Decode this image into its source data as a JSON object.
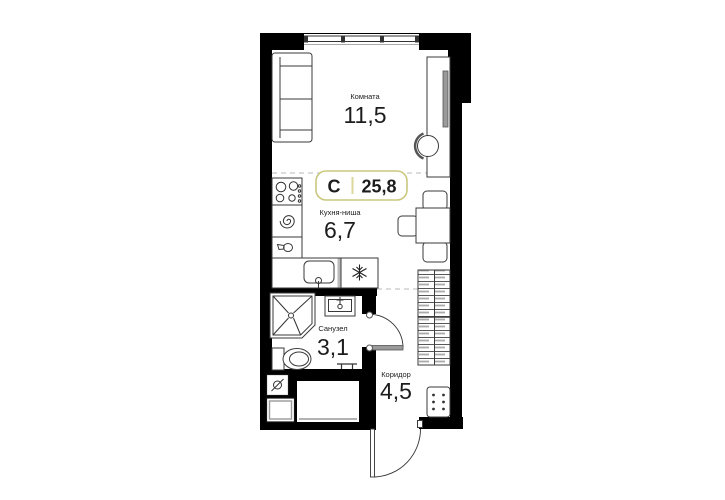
{
  "plan": {
    "badge": {
      "type_label": "С",
      "total_area": "25,8"
    },
    "rooms": [
      {
        "label": "Комната",
        "area": "11,5"
      },
      {
        "label": "Кухня-ниша",
        "area": "6,7"
      },
      {
        "label": "Санузел",
        "area": "3,1"
      },
      {
        "label": "Коридор",
        "area": "4,5"
      }
    ],
    "furniture": [
      "sofa",
      "wardrobe-desk",
      "desk-chair",
      "stove",
      "hob-spiral",
      "kettle",
      "kitchen-sink",
      "fridge",
      "dining-table",
      "dining-chairs",
      "shower",
      "washbasin",
      "toilet",
      "towel-rail",
      "water-meter",
      "washing-machine",
      "storage-niche",
      "hall-wardrobe",
      "shoe-cabinet",
      "bathroom-door",
      "entry-door",
      "window"
    ],
    "colors": {
      "wall": "#000000",
      "outline": "#3a3a3a",
      "gray": "#9a9a9a",
      "dash": "#c8c8c8",
      "badge_border": "#c9c77e",
      "badge_divider": "#dcd79b",
      "text": "#1c1c1c",
      "background": "#ffffff"
    }
  }
}
